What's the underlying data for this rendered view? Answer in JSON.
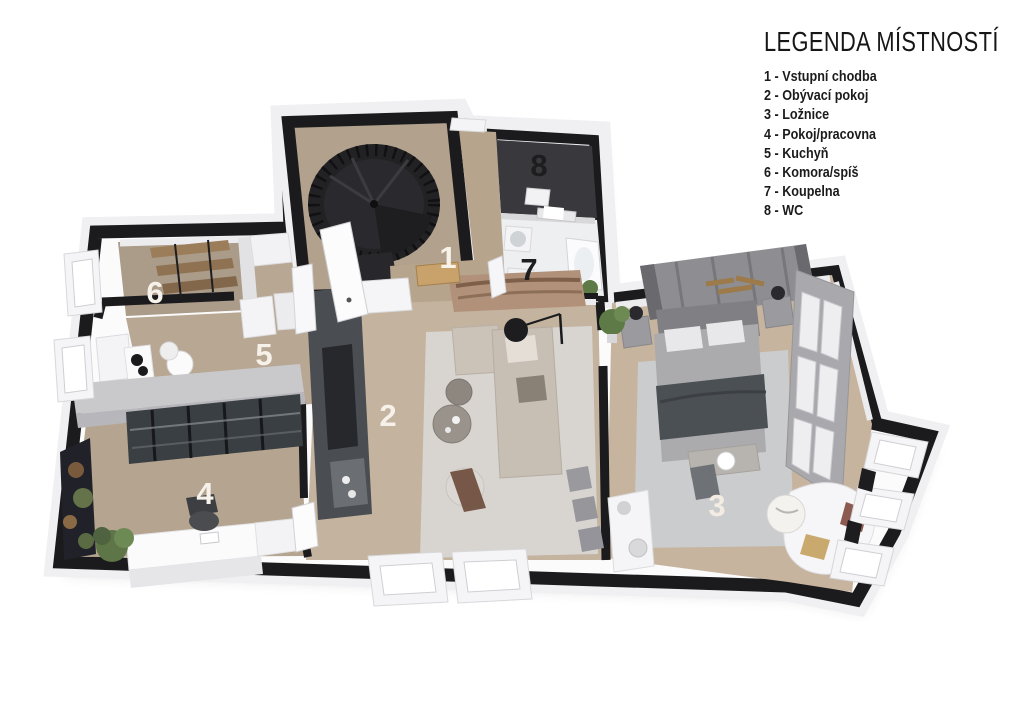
{
  "legend": {
    "title": "LEGENDA MÍSTNOSTÍ",
    "items": [
      {
        "num": "1",
        "label": "Vstupní chodba",
        "text": "1 - Vstupní chodba"
      },
      {
        "num": "2",
        "label": "Obývací pokoj",
        "text": "2 - Obývací pokoj"
      },
      {
        "num": "3",
        "label": "Ložnice",
        "text": "3 - Ložnice"
      },
      {
        "num": "4",
        "label": "Pokoj/pracovna",
        "text": "4 - Pokoj/pracovna"
      },
      {
        "num": "5",
        "label": "Kuchyň",
        "text": "5 - Kuchyň"
      },
      {
        "num": "6",
        "label": "Komora/spíš",
        "text": "6 - Komora/spíš"
      },
      {
        "num": "7",
        "label": "Koupelna",
        "text": "7 - Koupelna"
      },
      {
        "num": "8",
        "label": "WC",
        "text": "8 - WC"
      }
    ]
  },
  "plan": {
    "rooms": {
      "hall": {
        "number": "1"
      },
      "living": {
        "number": "2"
      },
      "bedroom": {
        "number": "3"
      },
      "office": {
        "number": "4"
      },
      "kitchen": {
        "number": "5"
      },
      "pantry": {
        "number": "6"
      },
      "bath": {
        "number": "7"
      },
      "wc": {
        "number": "8"
      }
    }
  },
  "colors": {
    "background": "#ffffff",
    "wall_black": "#1b1b1d",
    "wall_white_face": "#f0f0f2",
    "floor_wood": "#bcab96",
    "floor_wc_dark": "#3a3a3e",
    "floor_bath": "#edeff1",
    "rug_living": "#d8d5d1",
    "rug_bedroom": "#caccce",
    "tv_wall": "#4a4d52",
    "number_light": "#f6f2ea",
    "number_dark": "#1d1d1f",
    "legend_text": "#1a1a1a"
  }
}
